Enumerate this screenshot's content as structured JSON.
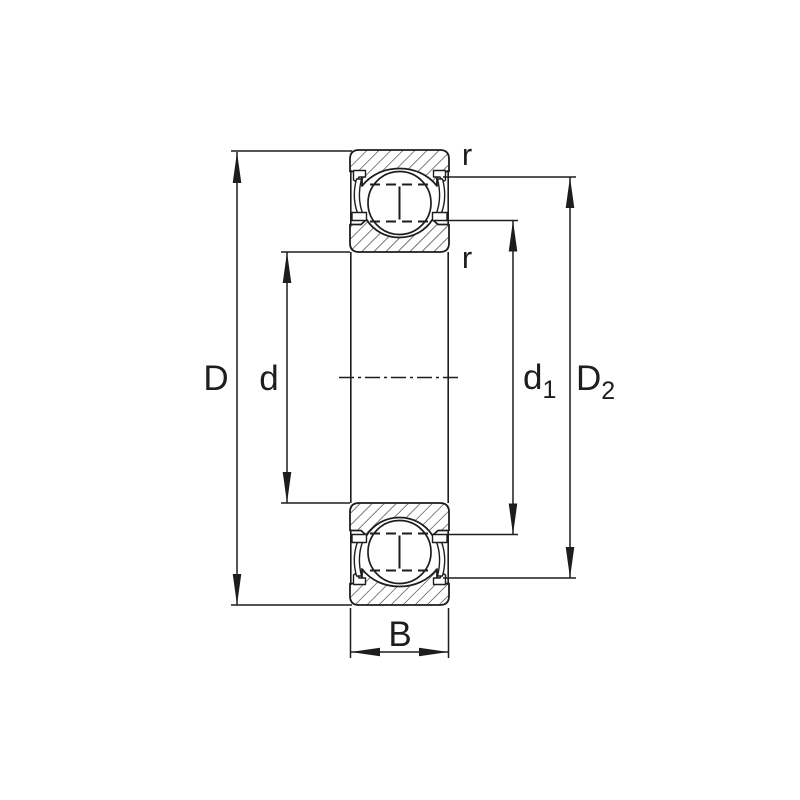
{
  "figure": {
    "kind": "bearing-cross-section-diagram",
    "background_color": "#ffffff",
    "line_color": "#1d1d1b"
  },
  "labels": {
    "outer_diameter": "D",
    "bore_diameter": "d",
    "shoulder_diameter_main": "d",
    "shoulder_diameter_sub": "1",
    "recess_diameter_main": "D",
    "recess_diameter_sub": "2",
    "width": "B",
    "radius_outer": "r",
    "radius_inner": "r"
  }
}
